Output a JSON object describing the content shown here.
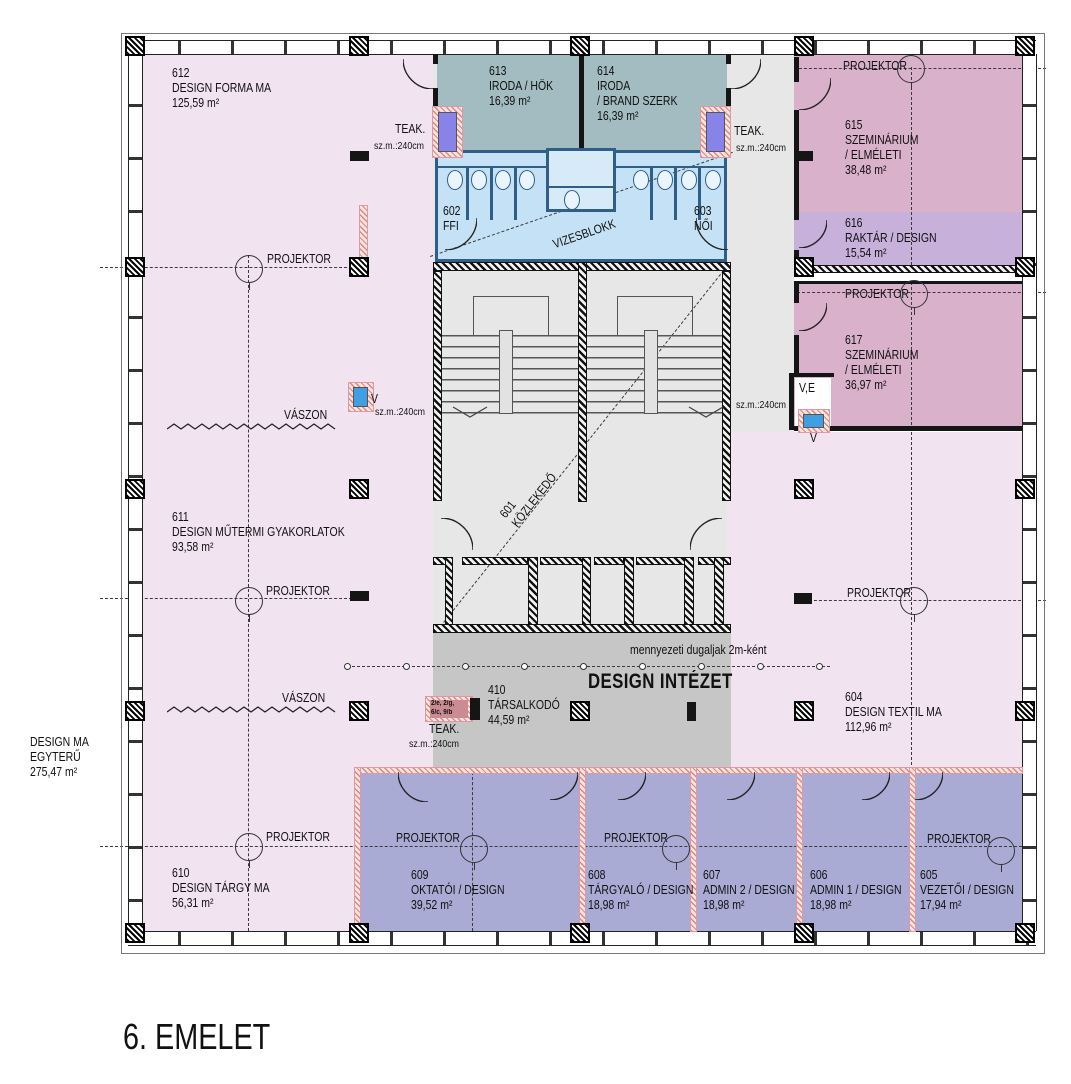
{
  "title": "6. EMELET",
  "labels": {
    "projektor": "PROJEKTOR",
    "vaszon": "VÁSZON",
    "teak": "TEAK.",
    "szm": "sz.m.:240cm",
    "v": "V",
    "ve": "V,E",
    "ceiling_note": "mennyezeti dugaljak 2m-ként",
    "institute": "DESIGN INTÉZET",
    "teak_ref1": "2/e, 2/g,",
    "teak_ref2": "6/c, 9/b"
  },
  "rooms": {
    "r612": {
      "num": "612",
      "name": "DESIGN FORMA MA",
      "area": "125,59 m²"
    },
    "r613": {
      "num": "613",
      "name": "IRODA / HÖK",
      "area": "16,39 m²"
    },
    "r614": {
      "num": "614",
      "name": "IRODA",
      "name2": "/ BRAND SZERK",
      "area": "16,39 m²"
    },
    "r615": {
      "num": "615",
      "name": "SZEMINÁRIUM",
      "name2": "/ ELMÉLETI",
      "area": "38,48 m²"
    },
    "r616": {
      "num": "616",
      "name": "RAKTÁR / DESIGN",
      "area": "15,54 m²"
    },
    "r617": {
      "num": "617",
      "name": "SZEMINÁRIUM",
      "name2": "/ ELMÉLETI",
      "area": "36,97 m²"
    },
    "r602": {
      "num": "602",
      "name": "FFI"
    },
    "r603": {
      "num": "603",
      "name": "NŐI"
    },
    "r601": {
      "num": "601",
      "name": "KÖZLEKEDŐ"
    },
    "vizesblokk": {
      "name": "VIZESBLOKK"
    },
    "r611": {
      "num": "611",
      "name": "DESIGN MŰTERMI GYAKORLATOK",
      "area": "93,58 m²"
    },
    "r610": {
      "num": "610",
      "name": "DESIGN TÁRGY MA",
      "area": "56,31 m²"
    },
    "r609": {
      "num": "609",
      "name": "OKTATÓI / DESIGN",
      "area": "39,52 m²"
    },
    "r608": {
      "num": "608",
      "name": "TÁRGYALÓ / DESIGN",
      "area": "18,98 m²"
    },
    "r607": {
      "num": "607",
      "name": "ADMIN 2 / DESIGN",
      "area": "18,98 m²"
    },
    "r606": {
      "num": "606",
      "name": "ADMIN 1 / DESIGN",
      "area": "18,98 m²"
    },
    "r605": {
      "num": "605",
      "name": "VEZETŐI / DESIGN",
      "area": "17,94 m²"
    },
    "r604": {
      "num": "604",
      "name": "DESIGN TEXTIL MA",
      "area": "112,96 m²"
    },
    "r410": {
      "num": "410",
      "name": "TÁRSALKODÓ",
      "area": "44,59 m²"
    },
    "design_ma": {
      "name": "DESIGN MA",
      "name2": "EGYTERŰ",
      "area": "275,47 m²"
    }
  },
  "colors": {
    "open_studio_pink": "#f2e3f1",
    "office_teal": "#a3bcc1",
    "wet_block_blue": "#c4e1f5",
    "seminar_mauve": "#dab1cb",
    "storage_violet": "#c7b0da",
    "admin_blue": "#a9abd5",
    "corridor_gray": "#e7e7e7",
    "institute_gray": "#c6c6c6",
    "kitchen_purple": "#8783e8",
    "sink_blue": "#3f9fe0"
  }
}
